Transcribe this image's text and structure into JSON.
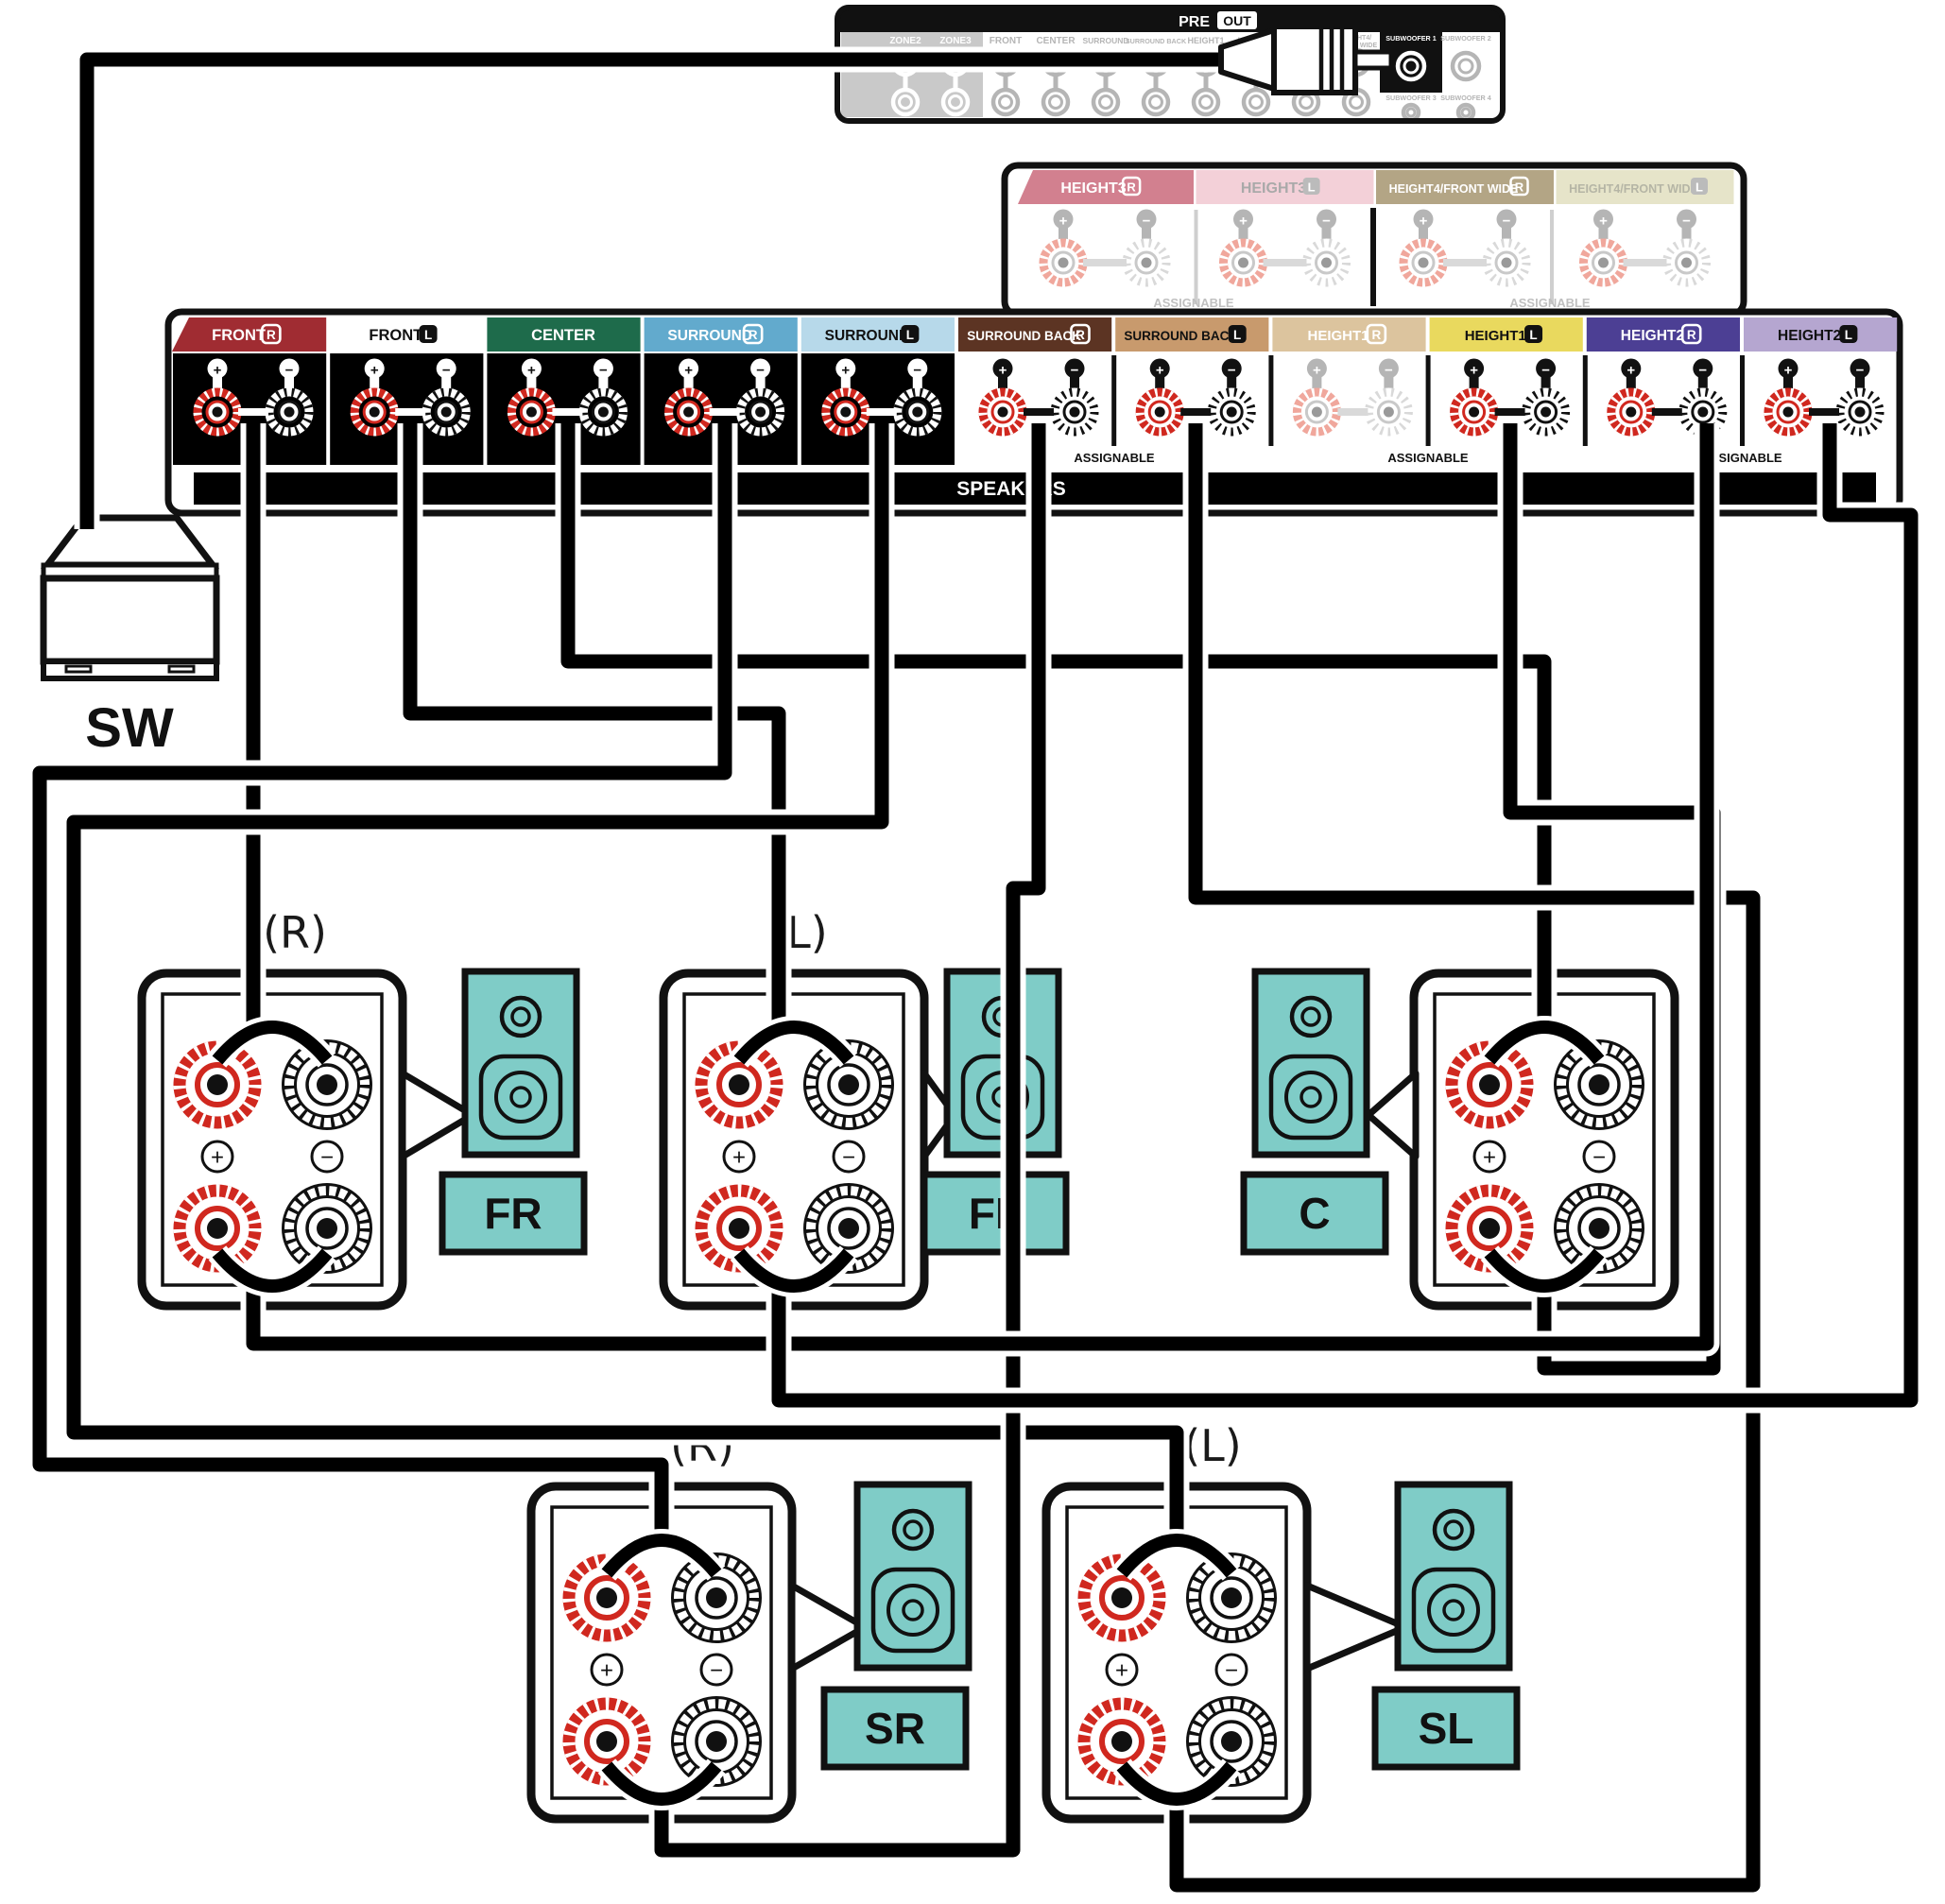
{
  "diagram": {
    "polarity": {
      "plus": "+",
      "minus": "−"
    },
    "colors": {
      "teal": "#7fccc7",
      "post_red": "#d0281f",
      "cable": "#000000",
      "faded_red": "#f0a79c",
      "faded_gray": "#b5b5b5"
    },
    "pre_out": {
      "pre": "PRE",
      "out": "OUT",
      "columns": [
        {
          "label": "ZONE2"
        },
        {
          "label": "ZONE3"
        },
        {
          "label": "FRONT"
        },
        {
          "label": "CENTER"
        },
        {
          "label": "SURROUND"
        },
        {
          "label": "SURROUND BACK"
        },
        {
          "label": "HEIGHT1"
        },
        {
          "label": "HEIGHT2"
        },
        {
          "label": "HEIGHT3"
        },
        {
          "label": "HEIGHT4/FRONT WIDE",
          "l1": "HEIGHT4/",
          "l2": "FRONT WIDE"
        },
        {
          "label": "SUBWOOFER 1",
          "highlight": true
        },
        {
          "label": "SUBWOOFER 2"
        },
        {
          "label": "SUBWOOFER 3"
        },
        {
          "label": "SUBWOOFER 4"
        }
      ]
    },
    "height_panel": {
      "assignable": "ASSIGNABLE",
      "sections": [
        {
          "label": "HEIGHT3",
          "channel": "R",
          "tab": "#d2808f",
          "text": "#fff"
        },
        {
          "label": "HEIGHT3",
          "channel": "L",
          "tab": "#f3d0d8",
          "text": "#a9a9a9"
        },
        {
          "label": "HEIGHT4/FRONT WIDE",
          "channel": "R",
          "tab": "#b3a585",
          "text": "#fff"
        },
        {
          "label": "HEIGHT4/FRONT WIDE",
          "channel": "L",
          "tab": "#e6e4c9",
          "text": "#b5b5a5"
        }
      ]
    },
    "speaker_panel": {
      "bar_label": "SPEAKERS",
      "assignable": "ASSIGNABLE",
      "sections": [
        {
          "label": "FRONT",
          "channel": "R",
          "tab": "#a02c32",
          "text": "#fff",
          "active": true
        },
        {
          "label": "FRONT",
          "channel": "L",
          "tab": "#ffffff",
          "text": "#111",
          "active": true
        },
        {
          "label": "CENTER",
          "channel": "",
          "tab": "#1e6b4b",
          "text": "#fff",
          "active": true
        },
        {
          "label": "SURROUND",
          "channel": "R",
          "tab": "#62aacd",
          "text": "#fff",
          "active": true
        },
        {
          "label": "SURROUND",
          "channel": "L",
          "tab": "#b7d9ea",
          "text": "#111",
          "active": true
        },
        {
          "label": "SURROUND BACK",
          "channel": "R",
          "tab": "#5c3423",
          "text": "#fff",
          "active": true
        },
        {
          "label": "SURROUND BACK",
          "channel": "L",
          "tab": "#c89a6d",
          "text": "#111",
          "active": true
        },
        {
          "label": "HEIGHT1",
          "channel": "R",
          "tab": "#dcc49e",
          "text": "#fff",
          "active": false
        },
        {
          "label": "HEIGHT1",
          "channel": "L",
          "tab": "#e9d95e",
          "text": "#111",
          "active": true
        },
        {
          "label": "HEIGHT2",
          "channel": "R",
          "tab": "#4c3f94",
          "text": "#fff",
          "active": true
        },
        {
          "label": "HEIGHT2",
          "channel": "L",
          "tab": "#b5a6d0",
          "text": "#111",
          "active": true
        }
      ]
    },
    "subwoofer": {
      "label": "SW"
    },
    "speakers": [
      {
        "id": "FR",
        "pos": "(R)"
      },
      {
        "id": "FL",
        "pos": "(L)"
      },
      {
        "id": "C",
        "pos": ""
      },
      {
        "id": "SR",
        "pos": "(R)"
      },
      {
        "id": "SL",
        "pos": "(L)"
      }
    ],
    "connections": [
      {
        "from": "PRE OUT SUBWOOFER 1",
        "to": "SW"
      },
      {
        "from": "FRONT R",
        "to": "FR top terminals"
      },
      {
        "from": "FRONT L",
        "to": "FL top terminals"
      },
      {
        "from": "CENTER",
        "to": "C top terminals"
      },
      {
        "from": "SURROUND R",
        "to": "SR top terminals"
      },
      {
        "from": "SURROUND L",
        "to": "SL top terminals"
      },
      {
        "from": "SURROUND BACK R",
        "to": "SR bottom terminals"
      },
      {
        "from": "SURROUND BACK L",
        "to": "SL bottom terminals"
      },
      {
        "from": "HEIGHT1 L",
        "to": "C bottom terminals"
      },
      {
        "from": "HEIGHT2 R",
        "to": "FR bottom terminals"
      },
      {
        "from": "HEIGHT2 L",
        "to": "FL bottom terminals"
      }
    ]
  }
}
